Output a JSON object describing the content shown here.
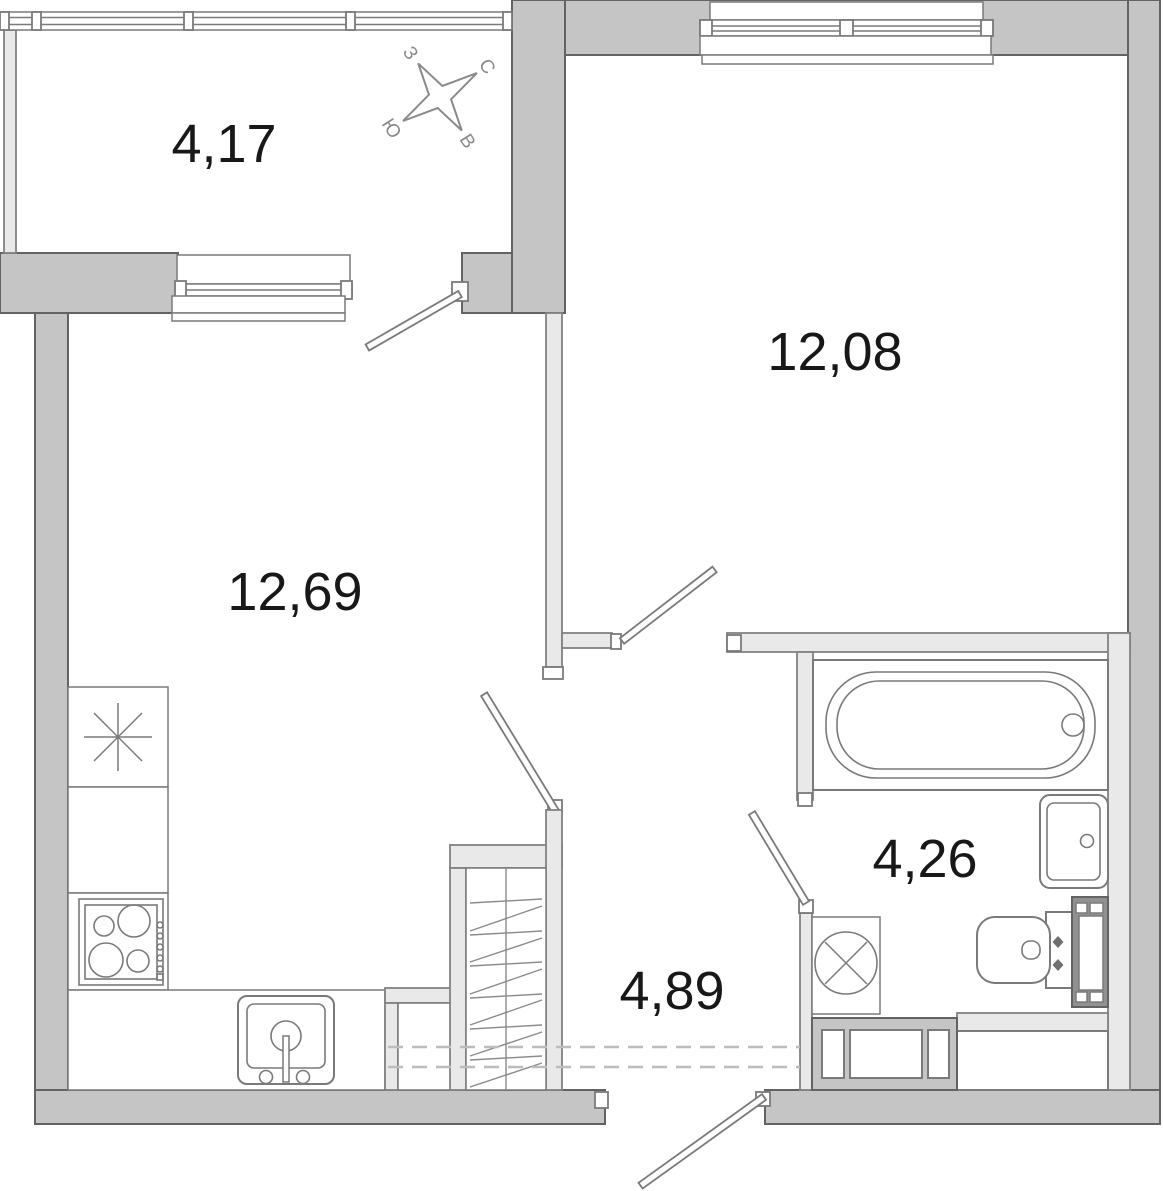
{
  "title": "one-room apartment floor plan",
  "rooms": [
    {
      "name": "loggia",
      "area": "4,17"
    },
    {
      "name": "bedroom",
      "area": "12,08"
    },
    {
      "name": "kitchen-living",
      "area": "12,69"
    },
    {
      "name": "bathroom",
      "area": "4,26"
    },
    {
      "name": "hallway",
      "area": "4,89"
    }
  ],
  "compass": {
    "north": "С",
    "south": "Ю",
    "west": "З",
    "east": "В"
  },
  "colors": {
    "wall_fill": "#c5c5c5",
    "wall_stroke": "#636363",
    "partition_fill": "#e9e9e9",
    "fixture_line": "#7a7a7a",
    "label_text": "#181818",
    "compass_gray": "#8a8a8a"
  }
}
